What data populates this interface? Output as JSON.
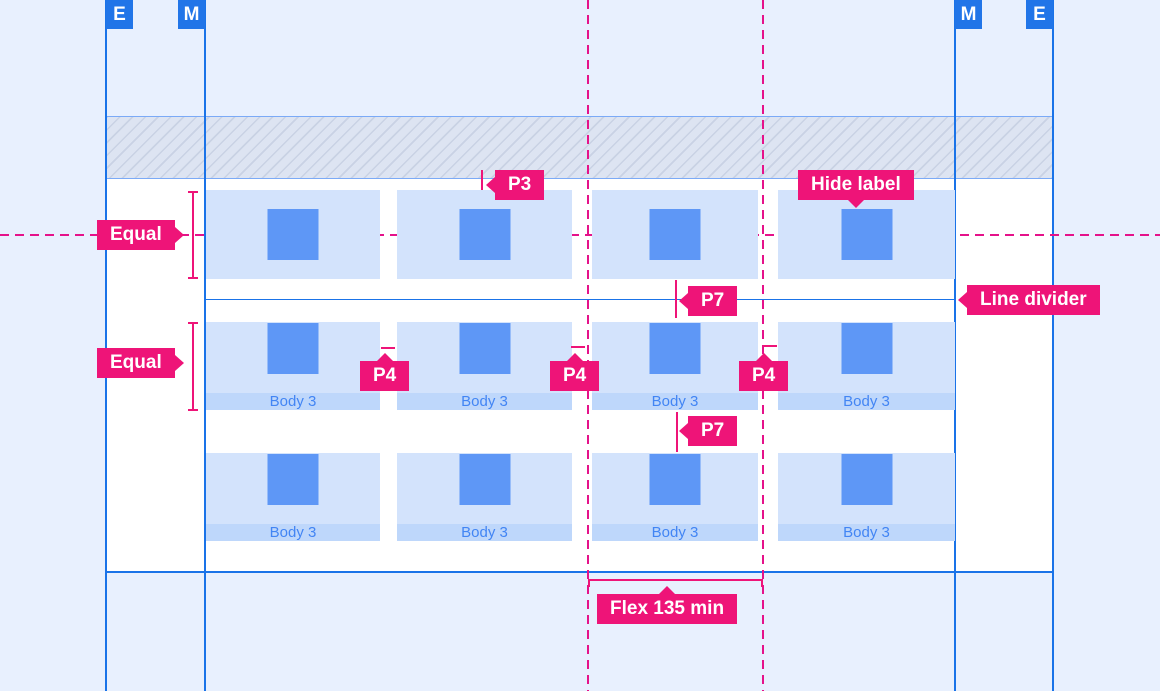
{
  "markers": {
    "left_e": "E",
    "left_m": "M",
    "right_m": "M",
    "right_e": "E"
  },
  "annotations": {
    "equal_top": "Equal",
    "equal_bottom": "Equal",
    "p3": "P3",
    "p4_1": "P4",
    "p4_2": "P4",
    "p4_3": "P4",
    "p7_top": "P7",
    "p7_bottom": "P7",
    "hide_label": "Hide label",
    "line_divider": "Line divider",
    "flex": "Flex 135 min"
  },
  "cards": {
    "row2": {
      "footers": [
        "Body 3",
        "Body 3",
        "Body 3",
        "Body 3"
      ]
    },
    "row3": {
      "footers": [
        "Body 3",
        "Body 3",
        "Body 3",
        "Body 3"
      ]
    }
  },
  "colors": {
    "canvas_bg": "#e8f0fe",
    "content_bg": "#ffffff",
    "guide_blue": "#1a73e8",
    "marker_blue": "#2175e8",
    "annotation_pink": "#ee1478",
    "dashed_guide_pink": "#e5128a",
    "card_bg": "#d3e3fc",
    "card_footer_bg": "#bed7fb",
    "tile_blue": "#5e97f6",
    "footer_text_blue": "#4285f4",
    "hatch_border_blue": "#7baaf7"
  }
}
